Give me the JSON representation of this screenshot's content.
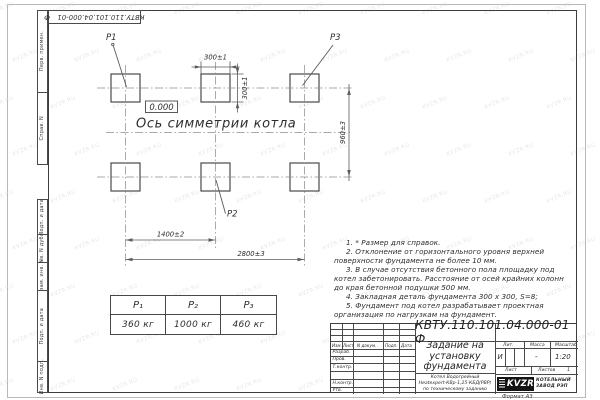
{
  "sheet": {
    "corner_stamp_doc_number": "КВТУ.110.101.04.000-01 Ф",
    "format_label": "Формат А3"
  },
  "stamps": {
    "margin_labels": [
      "Перв. примен.",
      "Справ. N",
      "Подп. и дата",
      "Инв. N дубл.",
      "Взам. инв. N",
      "Подп. и дата",
      "Инв. N подл."
    ]
  },
  "drawing": {
    "pad_labels": {
      "p1": "Р1",
      "p2": "Р2",
      "p3": "Р3"
    },
    "elevation_mark": "0.000",
    "axis_label": "Ось симметрии котла",
    "dimensions": {
      "pad_width": "300±1",
      "pad_height": "300±1",
      "row_spacing": "960±3",
      "col_spacing": "1400±2",
      "total_span": "2800±3"
    }
  },
  "load_table": {
    "headers": [
      "Р₁",
      "Р₂",
      "Р₃"
    ],
    "values": [
      "360 кг",
      "1000 кг",
      "460 кг"
    ]
  },
  "notes": [
    "1. * Размер для справок.",
    "2. Отклонение от горизонтального уровня верхней поверхности фундамента не более 10 мм.",
    "3. В случае отсутствия бетонного пола площадку под котел забетонировать. Расстояние от осей крайних колонн до края бетонной подушки 500 мм.",
    "4. Закладная деталь фундамента 300 х 300, S=8;",
    "5. Фундамент под котел разрабатывает проектная организация по нагрузкам на фундамент."
  ],
  "title_block": {
    "doc_number": "КВТУ.110.101.04.000-01 Ф",
    "title": "Задание на установку фундамента",
    "subtitle_lines": [
      "Котел Водогрейный",
      "Heatexpert-КВр-1,25-КБД(РВР)",
      "по техническому заданию"
    ],
    "col_headers": [
      "Изм.",
      "Лист",
      "N докум.",
      "Подп.",
      "Дата"
    ],
    "row_labels": [
      "Разраб.",
      "Пров.",
      "Т.контр.",
      "Н.контр.",
      "Утв."
    ],
    "lit_header": "Лит.",
    "mass_header": "Масса",
    "scale_header": "Масштаб",
    "lit_value": "И",
    "mass_value": "-",
    "scale_value": "1:20",
    "sheet_label": "Лист",
    "sheets_label": "Листов",
    "sheets_value": "1",
    "logo_text": "KVZR",
    "company_lines": [
      "КОТЕЛЬНЫЙ",
      "ЗАВОД РЭП"
    ]
  },
  "watermark": {
    "text": "KVZR.RU"
  }
}
